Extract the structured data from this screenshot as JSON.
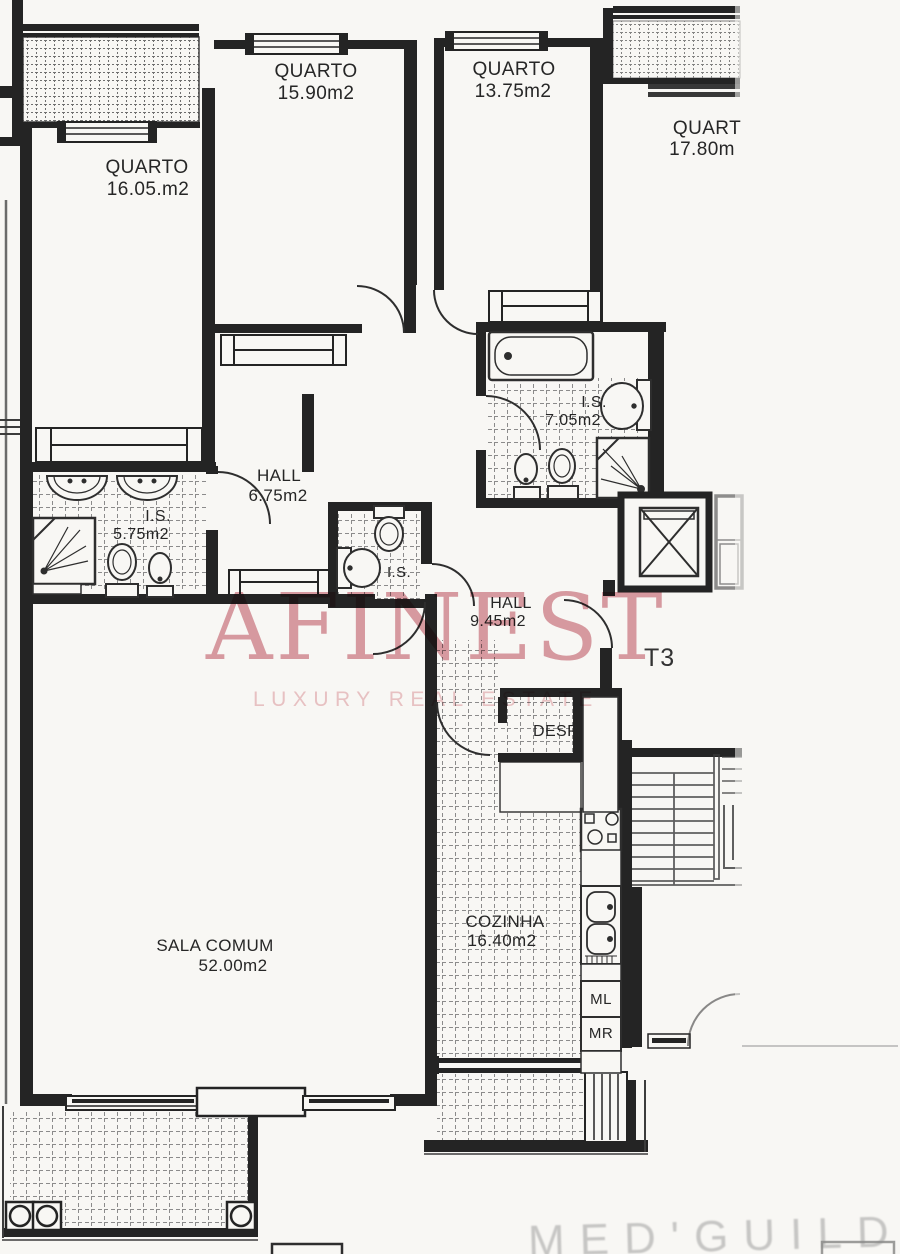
{
  "document_kind": "apartment floor plan scan",
  "unit_type_label": "T3",
  "watermark": {
    "brand": "AFINEST",
    "tagline": "LUXURY REAL ESTATE",
    "brand_color": "#d2838d",
    "tagline_color": "#edc4c8"
  },
  "stamp": {
    "text": "MED'GUILD",
    "color": "#8a8a8a"
  },
  "colors": {
    "paper": "#f8f7f4",
    "ink": "#242424"
  },
  "rooms": {
    "quarto_16_05": {
      "name": "QUARTO",
      "area": "16.05.m2"
    },
    "quarto_15_90": {
      "name": "QUARTO",
      "area": "15.90m2"
    },
    "quarto_13_75": {
      "name": "QUARTO",
      "area": "13.75m2"
    },
    "quarto_17_80": {
      "name": "QUART",
      "area": "17.80m"
    },
    "is_5_75": {
      "name": "I.S.",
      "area": "5.75m2"
    },
    "is_7_05": {
      "name": "I.S.",
      "area": "7.05m2"
    },
    "wc": {
      "name": "I.S."
    },
    "hall_6_75": {
      "name": "HALL",
      "area": "6.75m2"
    },
    "hall_9_45": {
      "name": "HALL",
      "area": "9.45m2"
    },
    "despensa": {
      "name": "DESP."
    },
    "cozinha": {
      "name": "COZINHA",
      "area": "16.40m2"
    },
    "sala_comum": {
      "name": "SALA COMUM",
      "area": "52.00m2"
    }
  },
  "appliances": {
    "ml": "ML",
    "mr": "MR"
  }
}
